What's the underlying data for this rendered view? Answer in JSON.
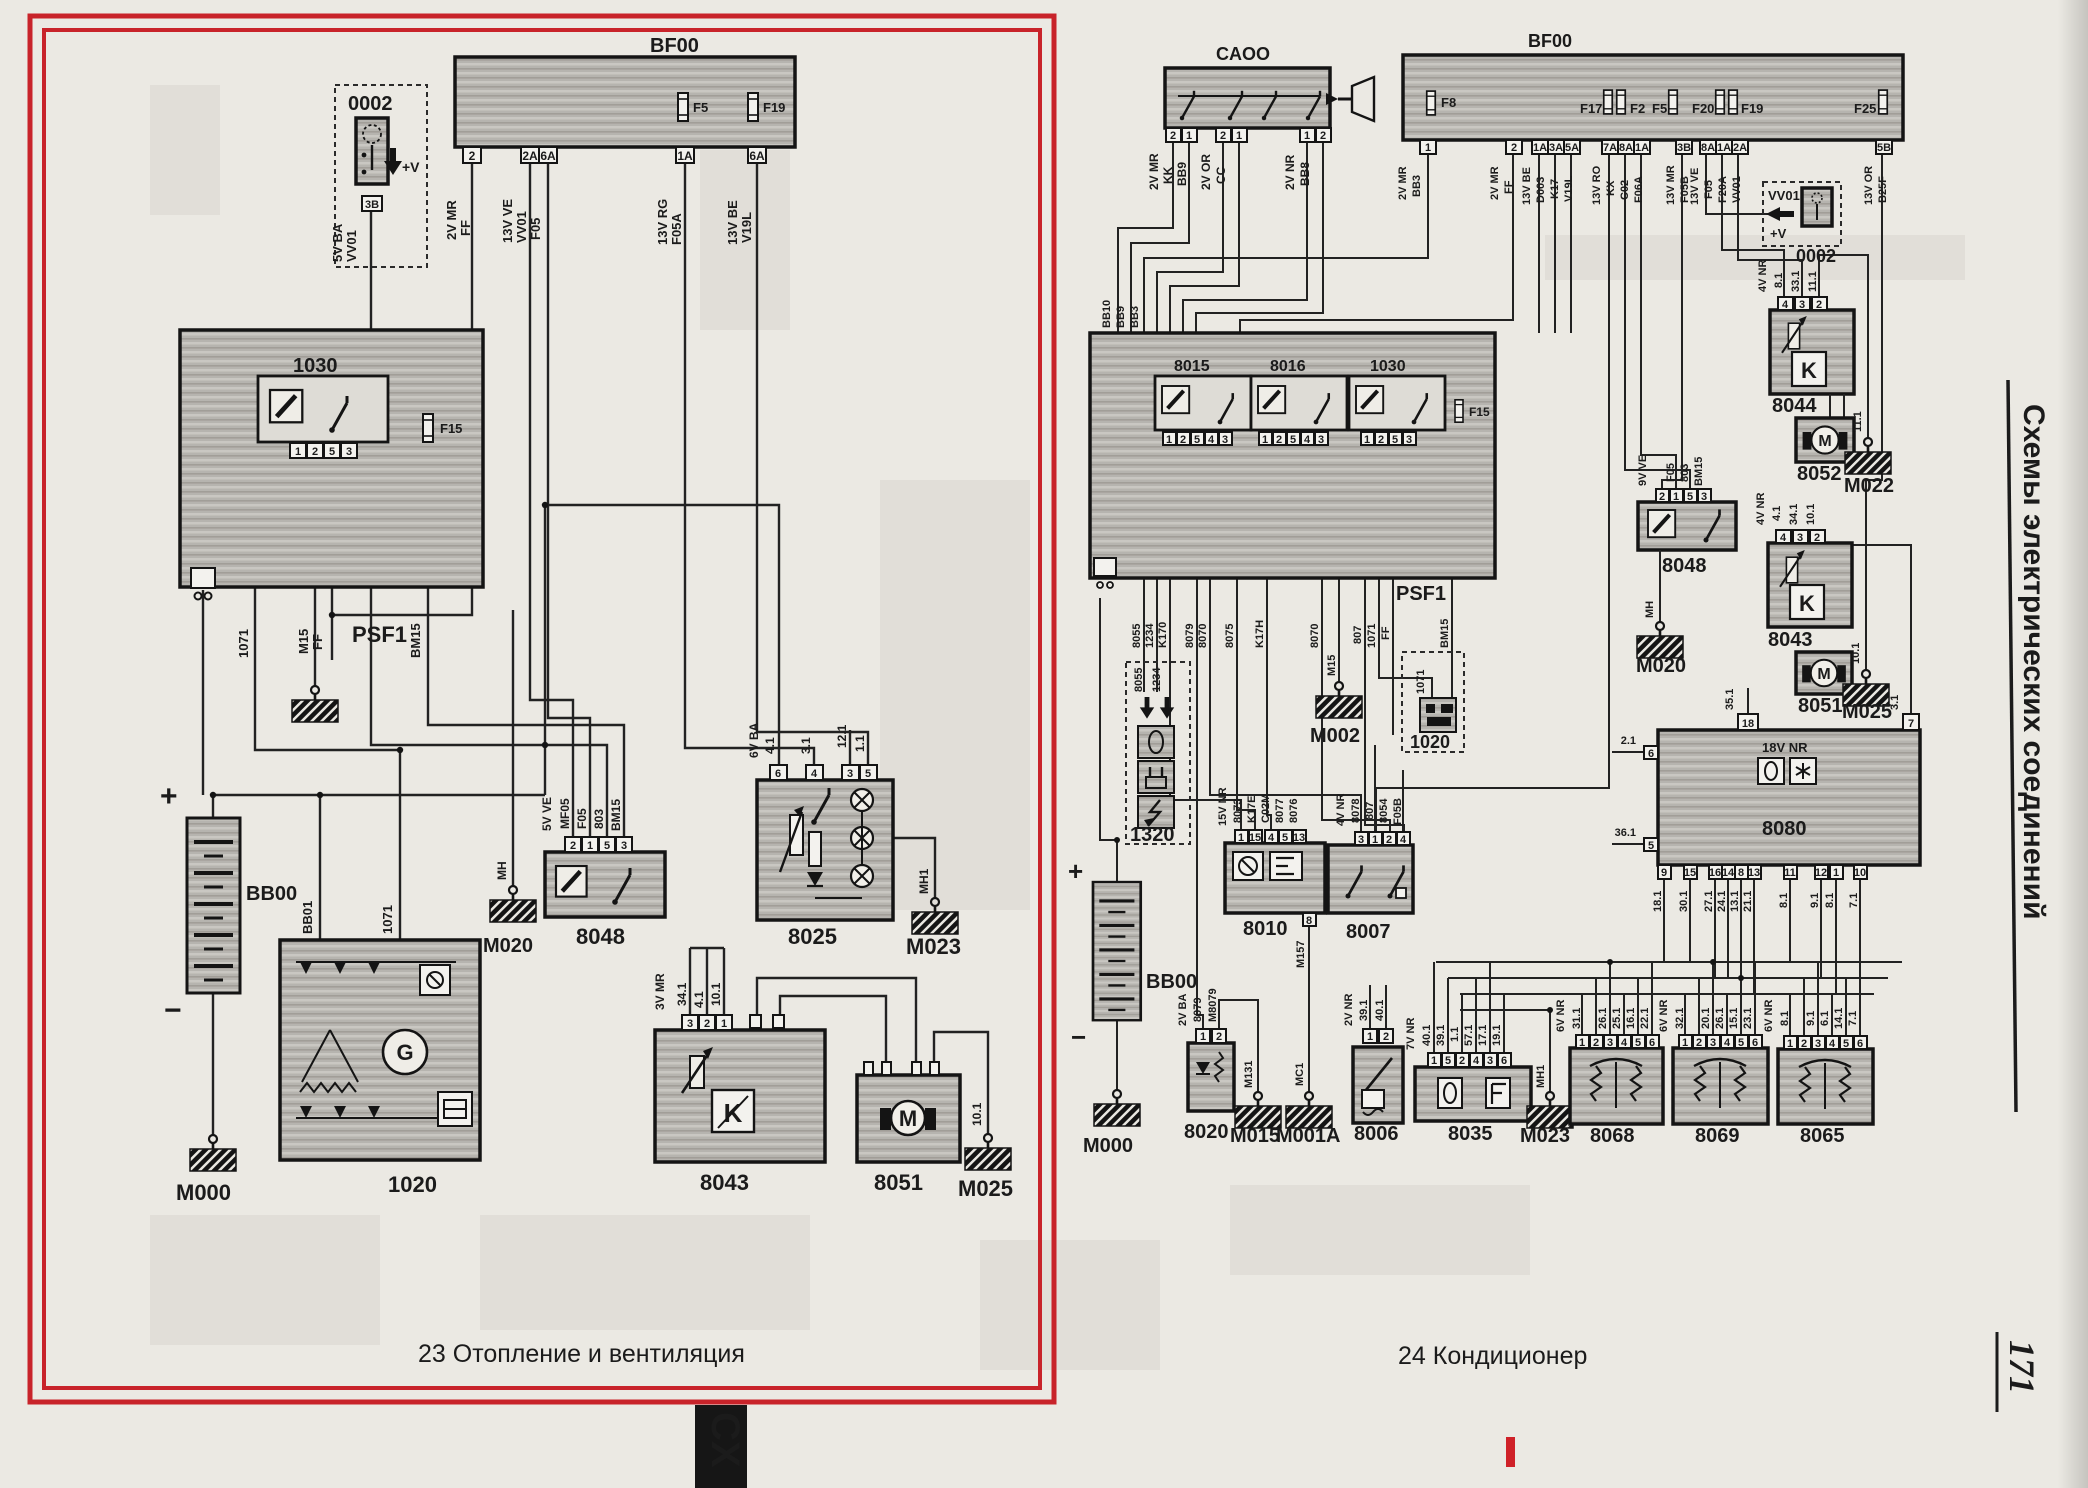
{
  "page": {
    "sidebar_title": "Схемы электрических соединений",
    "page_number": "171",
    "bottom_tab": "CX",
    "caption_left": "23 Отопление и вентиляция",
    "caption_right": "24 Кондиционер",
    "accent_red": "#c8232a"
  },
  "left": {
    "u0002": {
      "id": "0002",
      "pin": "3B",
      "plus_v": "+V",
      "wires": [
        "5V BA",
        "VV01"
      ]
    },
    "bf00": {
      "id": "BF00",
      "fuses": [
        "F5",
        "F19"
      ],
      "pins": [
        "2",
        "2A",
        "6A",
        "1A",
        "6A"
      ],
      "wires": [
        "2V MR",
        "FF",
        "13V VE",
        "VV01",
        "F05",
        "13V RG",
        "F05A",
        "13V BE",
        "V19L"
      ]
    },
    "psf1": {
      "id": "PSF1",
      "relay": "1030",
      "relay_pins": [
        "1",
        "2",
        "5",
        "3"
      ],
      "fuse": "F15",
      "wires": [
        "1071",
        "M15",
        "FF",
        "BM15"
      ]
    },
    "battery": {
      "id": "BB00",
      "plus": "+",
      "minus": "−"
    },
    "m000": {
      "id": "M000"
    },
    "m020": {
      "id": "M020",
      "wire": "MH"
    },
    "u1020": {
      "id": "1020",
      "g": "G",
      "wires": [
        "BB01",
        "1071"
      ]
    },
    "u8048": {
      "id": "8048",
      "pins": [
        "2",
        "1",
        "5",
        "3"
      ],
      "wires": [
        "5V VE",
        "MF05",
        "F05",
        "803",
        "BM15"
      ]
    },
    "u8025": {
      "id": "8025",
      "pins": [
        "6",
        "4",
        "3",
        "5"
      ],
      "wires": [
        "6V BA",
        "4.1",
        "3.1",
        "12.1",
        "1.1"
      ]
    },
    "m023": {
      "id": "M023",
      "wire": "MH1"
    },
    "u8043": {
      "id": "8043",
      "k": "K",
      "pins": [
        "3",
        "2",
        "1"
      ],
      "wires": [
        "3V MR",
        "34.1",
        "4.1",
        "10.1"
      ]
    },
    "u8051": {
      "id": "8051",
      "m": "M"
    },
    "m025": {
      "id": "M025",
      "wire": "10.1"
    }
  },
  "right": {
    "ca00": {
      "id": "CAOO",
      "pins": [
        "2",
        "1",
        "2",
        "1",
        "1",
        "2"
      ],
      "wires": [
        "2V MR",
        "KK",
        "BB9",
        "2V OR",
        "CC",
        "2V NR",
        "BB8"
      ]
    },
    "bf00": {
      "id": "BF00",
      "fuses": [
        "F8",
        "F17",
        "F2",
        "F5",
        "F20",
        "F19",
        "F25"
      ],
      "pins": [
        "1",
        "2",
        "1A",
        "3A",
        "5A",
        "7A",
        "8A",
        "1A",
        "3B",
        "8A",
        "1A",
        "2A",
        "5B"
      ],
      "wires": [
        "2V MR",
        "BB3",
        "2V MR",
        "FF",
        "13V BE",
        "D003",
        "K17",
        "V19L",
        "13V RO",
        "KX",
        "C02",
        "F06A",
        "13V MR",
        "F05B",
        "13V VE",
        "F05",
        "F20A",
        "VV01",
        "13V OR",
        "B25F"
      ]
    },
    "u0002": {
      "id": "0002",
      "wire": "VV01",
      "plus_v": "+V"
    },
    "psf1": {
      "id": "PSF1",
      "fuse": "F15",
      "entry_wires": [
        "BB10",
        "BB9",
        "BB3"
      ],
      "relays": [
        {
          "id": "8015",
          "pins": [
            "1",
            "2",
            "5",
            "4",
            "3"
          ]
        },
        {
          "id": "8016",
          "pins": [
            "1",
            "2",
            "5",
            "4",
            "3"
          ]
        },
        {
          "id": "1030",
          "pins": [
            "1",
            "2",
            "5",
            "3"
          ]
        }
      ],
      "wires": [
        "8055",
        "1234",
        "K170",
        "8079",
        "8070",
        "8075",
        "K17H",
        "8070",
        "M15",
        "807",
        "1071",
        "FF",
        "BM15"
      ]
    },
    "u1320": {
      "id": "1320",
      "wires": [
        "8055",
        "1234"
      ]
    },
    "m002": {
      "id": "M002"
    },
    "u1020": {
      "id": "1020",
      "wire": "1071"
    },
    "u8010": {
      "id": "8010",
      "pins": [
        "1",
        "15",
        "4",
        "5",
        "13"
      ],
      "bottom_pin": "8",
      "wires": [
        "15V NR",
        "8073",
        "K17E",
        "C02M",
        "8077",
        "8076"
      ],
      "bottom_wire": "M157"
    },
    "u8007": {
      "id": "8007",
      "pins": [
        "3",
        "1",
        "2",
        "4"
      ],
      "wires": [
        "4V NR",
        "8078",
        "807",
        "8054",
        "F05B"
      ]
    },
    "u8080": {
      "id": "8080",
      "label": "18V NR",
      "top_pins": [
        "18",
        "7"
      ],
      "top_wires": [
        "35.1",
        "3.1"
      ],
      "left_pins": [
        "6",
        "5"
      ],
      "left_wires": [
        "2.1",
        "36.1"
      ],
      "bottom_pins": [
        "9",
        "15",
        "16",
        "14",
        "8",
        "13",
        "11",
        "12",
        "1",
        "10"
      ],
      "bottom_wires": [
        "18.1",
        "30.1",
        "27.1",
        "24.1",
        "13.1",
        "21.1",
        "8.1",
        "9.1",
        "8.1",
        "7.1"
      ]
    },
    "u8044": {
      "id": "8044",
      "k": "K",
      "pins": [
        "4",
        "3",
        "2"
      ],
      "wires": [
        "4V NR",
        "8.1",
        "33.1",
        "11.1"
      ]
    },
    "u8052": {
      "id": "8052",
      "m": "M"
    },
    "m022": {
      "id": "M022",
      "wire": "11.1"
    },
    "u8048": {
      "id": "8048",
      "pins": [
        "2",
        "1",
        "5",
        "3"
      ],
      "wires": [
        "9V VE",
        "F05",
        "803",
        "BM15"
      ]
    },
    "m020": {
      "id": "M020",
      "wire": "MH"
    },
    "u8043": {
      "id": "8043",
      "k": "K",
      "pins": [
        "4",
        "3",
        "2"
      ],
      "wires": [
        "4V NR",
        "4.1",
        "34.1",
        "10.1"
      ]
    },
    "u8051": {
      "id": "8051",
      "m": "M"
    },
    "m025": {
      "id": "M025",
      "wire": "10.1"
    },
    "battery": {
      "id": "BB00",
      "plus": "+",
      "minus": "−"
    },
    "m000": {
      "id": "M000"
    },
    "u8020": {
      "id": "8020",
      "pins": [
        "1",
        "2"
      ],
      "wires": [
        "2V BA",
        "8079",
        "M8079"
      ]
    },
    "m015": {
      "id": "M015",
      "wire": "M131"
    },
    "m001a": {
      "id": "M001A",
      "wire": "MC1"
    },
    "u8006": {
      "id": "8006",
      "pins": [
        "1",
        "2"
      ],
      "wires": [
        "2V NR",
        "39.1",
        "40.1"
      ]
    },
    "u8035": {
      "id": "8035",
      "pins": [
        "1",
        "5",
        "2",
        "4",
        "3",
        "6"
      ],
      "wires": [
        "7V NR",
        "40.1",
        "39.1",
        "1.1",
        "57.1",
        "17.1",
        "19.1"
      ]
    },
    "m023": {
      "id": "M023",
      "wire": "MH1"
    },
    "u8068": {
      "id": "8068",
      "pins": [
        "1",
        "2",
        "3",
        "4",
        "5",
        "6"
      ],
      "wires": [
        "6V NR",
        "31.1",
        "26.1",
        "25.1",
        "16.1",
        "22.1"
      ]
    },
    "u8069": {
      "id": "8069",
      "pins": [
        "1",
        "2",
        "3",
        "4",
        "5",
        "6"
      ],
      "wires": [
        "6V NR",
        "32.1",
        "20.1",
        "26.1",
        "15.1",
        "23.1"
      ]
    },
    "u8065": {
      "id": "8065",
      "pins": [
        "1",
        "2",
        "3",
        "4",
        "5",
        "6"
      ],
      "wires": [
        "6V NR",
        "8.1",
        "9.1",
        "6.1",
        "14.1",
        "7.1"
      ]
    }
  }
}
